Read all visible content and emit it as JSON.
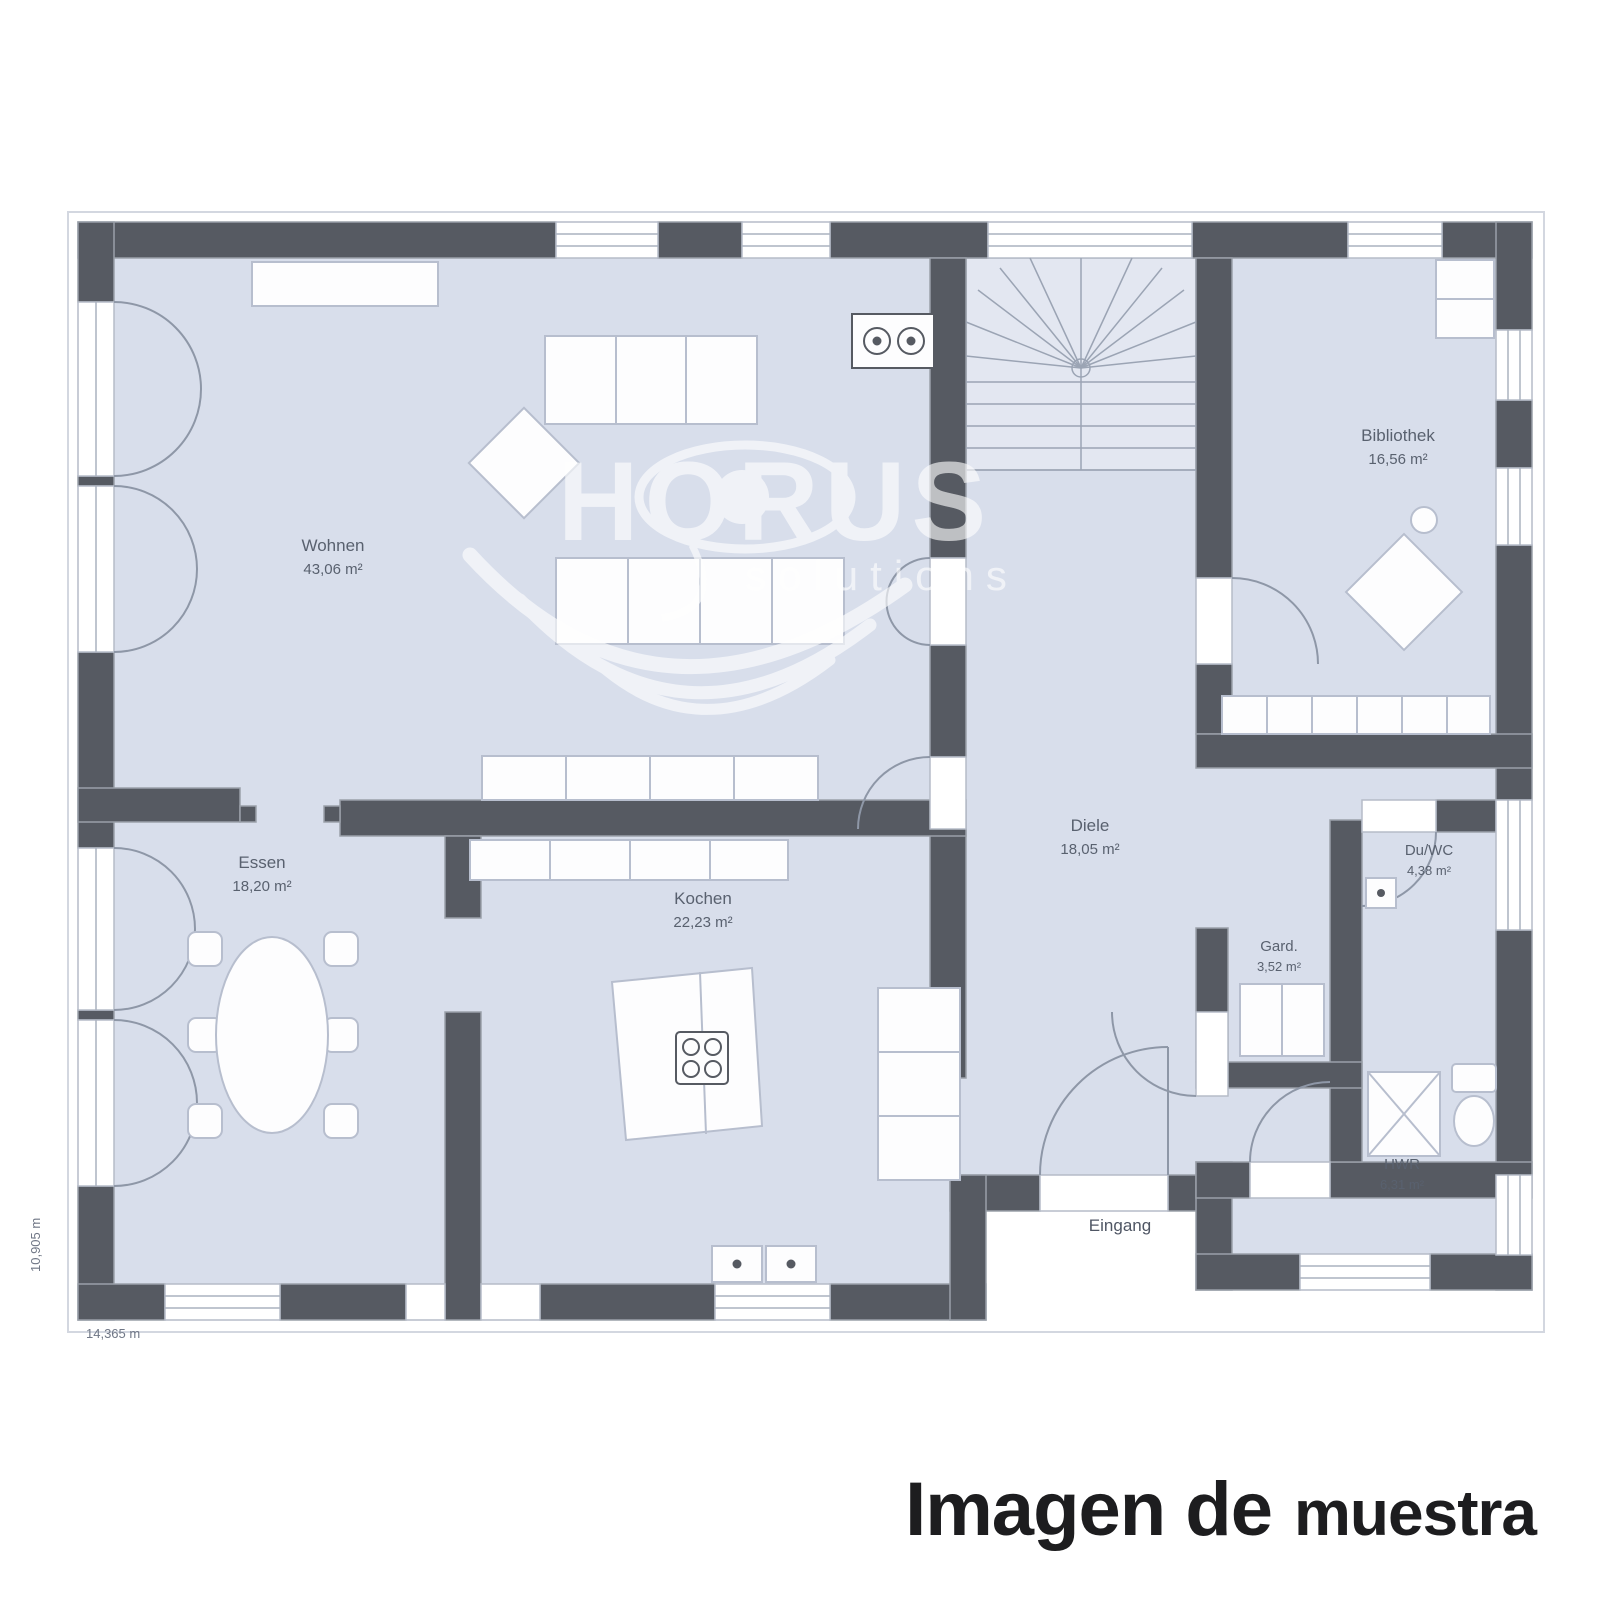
{
  "watermark": {
    "brand": "HORUS",
    "tagline": "solutions"
  },
  "caption": {
    "part1": "Imagen de",
    "part2": "muestra"
  },
  "rooms": [
    {
      "id": "wohnen",
      "name": "Wohnen",
      "area": "43,06 m²"
    },
    {
      "id": "essen",
      "name": "Essen",
      "area": "18,20 m²"
    },
    {
      "id": "kochen",
      "name": "Kochen",
      "area": "22,23 m²"
    },
    {
      "id": "diele",
      "name": "Diele",
      "area": "18,05 m²"
    },
    {
      "id": "bibliothek",
      "name": "Bibliothek",
      "area": "16,56 m²"
    },
    {
      "id": "duwc",
      "name": "Du/WC",
      "area": "4,38 m²"
    },
    {
      "id": "gard",
      "name": "Gard.",
      "area": "3,52 m²"
    },
    {
      "id": "hwr",
      "name": "HWR",
      "area": "6,31 m²"
    }
  ],
  "labels": {
    "entrance": "Eingang"
  },
  "dimensions": {
    "bottom": "14,365 m",
    "left": "10,905 m"
  },
  "colors": {
    "floor": "#d8deeb",
    "stair_floor": "#e3e7f1",
    "wall": "#565a62",
    "furniture_outline": "#b7bece",
    "label_text": "#59616f",
    "caption_text": "#1d1d1f",
    "watermark": "#ffffff"
  }
}
